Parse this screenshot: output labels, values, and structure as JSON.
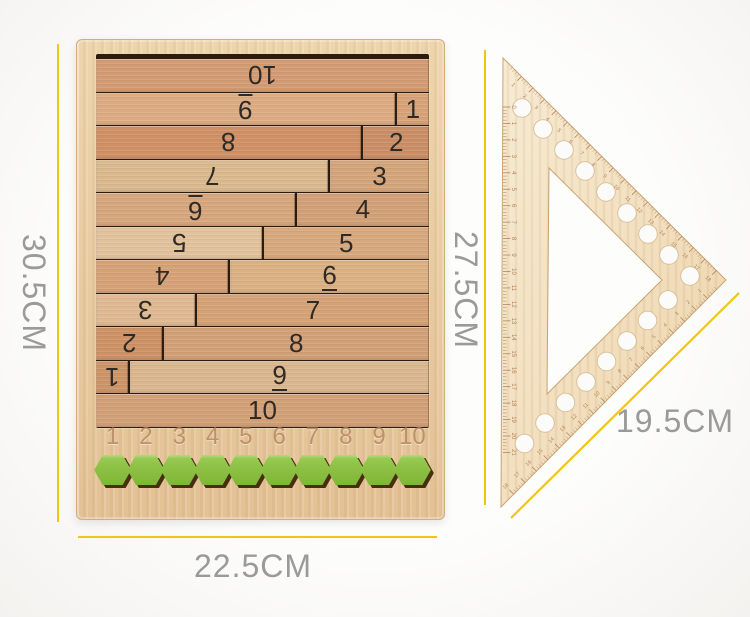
{
  "scene": {
    "background": "#fbfbfa",
    "dimension_line_color": "#F2C512",
    "dimension_text_color": "#9A9A9A"
  },
  "dimensions": {
    "board_height_label": "30.5CM",
    "board_width_label": "22.5CM",
    "triangle_height_label": "27.5CM",
    "triangle_side_label": "19.5CM"
  },
  "board": {
    "wood_color": "#E9CDA3",
    "recess_color": "#2B1C0F",
    "rod_number_color": "#2F2A25",
    "engraved_number_color": "#BF9168",
    "rows": [
      {
        "left": {
          "label": "10",
          "flipped": true,
          "underlined": false,
          "units": 10,
          "color": "#d39b73"
        },
        "right": null
      },
      {
        "left": {
          "label": "9",
          "flipped": true,
          "underlined": true,
          "units": 9,
          "color": "#dcab82"
        },
        "right": {
          "label": "1",
          "underlined": false,
          "units": 1,
          "color": "#d7a278"
        }
      },
      {
        "left": {
          "label": "8",
          "flipped": true,
          "underlined": false,
          "units": 8,
          "color": "#cf9065"
        },
        "right": {
          "label": "2",
          "underlined": false,
          "units": 2,
          "color": "#ca8e66"
        }
      },
      {
        "left": {
          "label": "7",
          "flipped": true,
          "underlined": false,
          "units": 7,
          "color": "#dab98e"
        },
        "right": {
          "label": "3",
          "underlined": false,
          "units": 3,
          "color": "#d4a57b"
        }
      },
      {
        "left": {
          "label": "6",
          "flipped": true,
          "underlined": true,
          "units": 6,
          "color": "#d6a67c"
        },
        "right": {
          "label": "4",
          "underlined": false,
          "units": 4,
          "color": "#d1a077"
        }
      },
      {
        "left": {
          "label": "5",
          "flipped": true,
          "underlined": false,
          "units": 5,
          "color": "#e2c29d"
        },
        "right": {
          "label": "5",
          "underlined": false,
          "units": 5,
          "color": "#d7a87d"
        }
      },
      {
        "left": {
          "label": "4",
          "flipped": true,
          "underlined": false,
          "units": 4,
          "color": "#d5a177"
        },
        "right": {
          "label": "6",
          "underlined": true,
          "units": 6,
          "color": "#dbb083"
        }
      },
      {
        "left": {
          "label": "3",
          "flipped": true,
          "underlined": false,
          "units": 3,
          "color": "#dfb991"
        },
        "right": {
          "label": "7",
          "underlined": false,
          "units": 7,
          "color": "#d5a276"
        }
      },
      {
        "left": {
          "label": "2",
          "flipped": true,
          "underlined": false,
          "units": 2,
          "color": "#cd9266"
        },
        "right": {
          "label": "8",
          "underlined": false,
          "units": 8,
          "color": "#d2a077"
        }
      },
      {
        "left": {
          "label": "1",
          "flipped": true,
          "underlined": false,
          "units": 1,
          "color": "#cc9468"
        },
        "right": {
          "label": "9",
          "underlined": true,
          "units": 9,
          "color": "#dab78e"
        }
      },
      {
        "left": {
          "label": "10",
          "flipped": false,
          "underlined": false,
          "units": 10,
          "color": "#d2a077"
        },
        "right": null
      }
    ],
    "bottom_scale": [
      "1",
      "2",
      "3",
      "4",
      "5",
      "6",
      "7",
      "8",
      "9",
      "10"
    ],
    "hexagons": {
      "count": 10,
      "color": "#8DC044",
      "shadow_color": "#46300F"
    }
  },
  "triangle": {
    "wood_color": "#F3E2C3",
    "mark_color": "#B5835A",
    "hole_count": 17,
    "vertical_scale": [
      "0",
      "1",
      "2",
      "3",
      "4",
      "5",
      "6",
      "7",
      "8",
      "9",
      "10",
      "11",
      "12",
      "13",
      "14",
      "15",
      "16",
      "17",
      "18",
      "19",
      "20",
      "21"
    ],
    "hypotenuse_scale": [
      "1",
      "2",
      "3",
      "4",
      "5",
      "6",
      "7",
      "8",
      "9",
      "10",
      "11",
      "12",
      "13",
      "14",
      "15",
      "16",
      "17",
      "18"
    ],
    "bottom_edge_scale": [
      "1",
      "2",
      "3",
      "4",
      "5",
      "6",
      "7",
      "8",
      "9",
      "10",
      "11",
      "12",
      "13",
      "14",
      "15",
      "16",
      "17",
      "18"
    ]
  }
}
